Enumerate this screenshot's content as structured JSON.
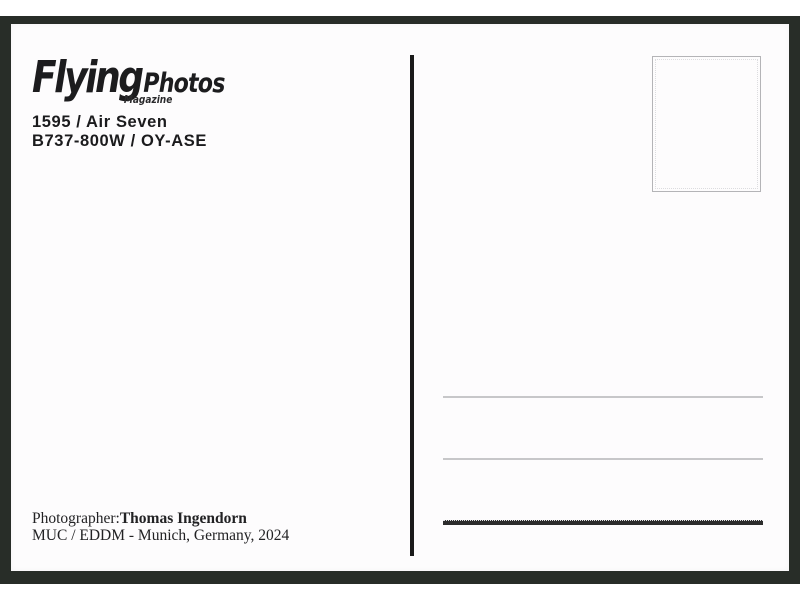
{
  "postcard": {
    "logo": {
      "brand": "Flying",
      "suffix": "Photos",
      "tagline": "Magazine"
    },
    "photo_info": {
      "number_and_airline": "1595 / Air Seven",
      "aircraft_and_registration": "B737-800W / OY-ASE"
    },
    "credit": {
      "label": "Photographer:",
      "photographer": "Thomas Ingendorn",
      "location": "MUC / EDDM - Munich, Germany, 2024"
    },
    "colors": {
      "scan_frame": "#282d28",
      "paper": "#fdfcfd",
      "ink": "#1c1c1e",
      "divider": "#1a1a1a",
      "address_line_light": "#c7c7c9",
      "address_line_dark": "#2c2c2c",
      "stamp_border": "#b4b4b7"
    }
  }
}
